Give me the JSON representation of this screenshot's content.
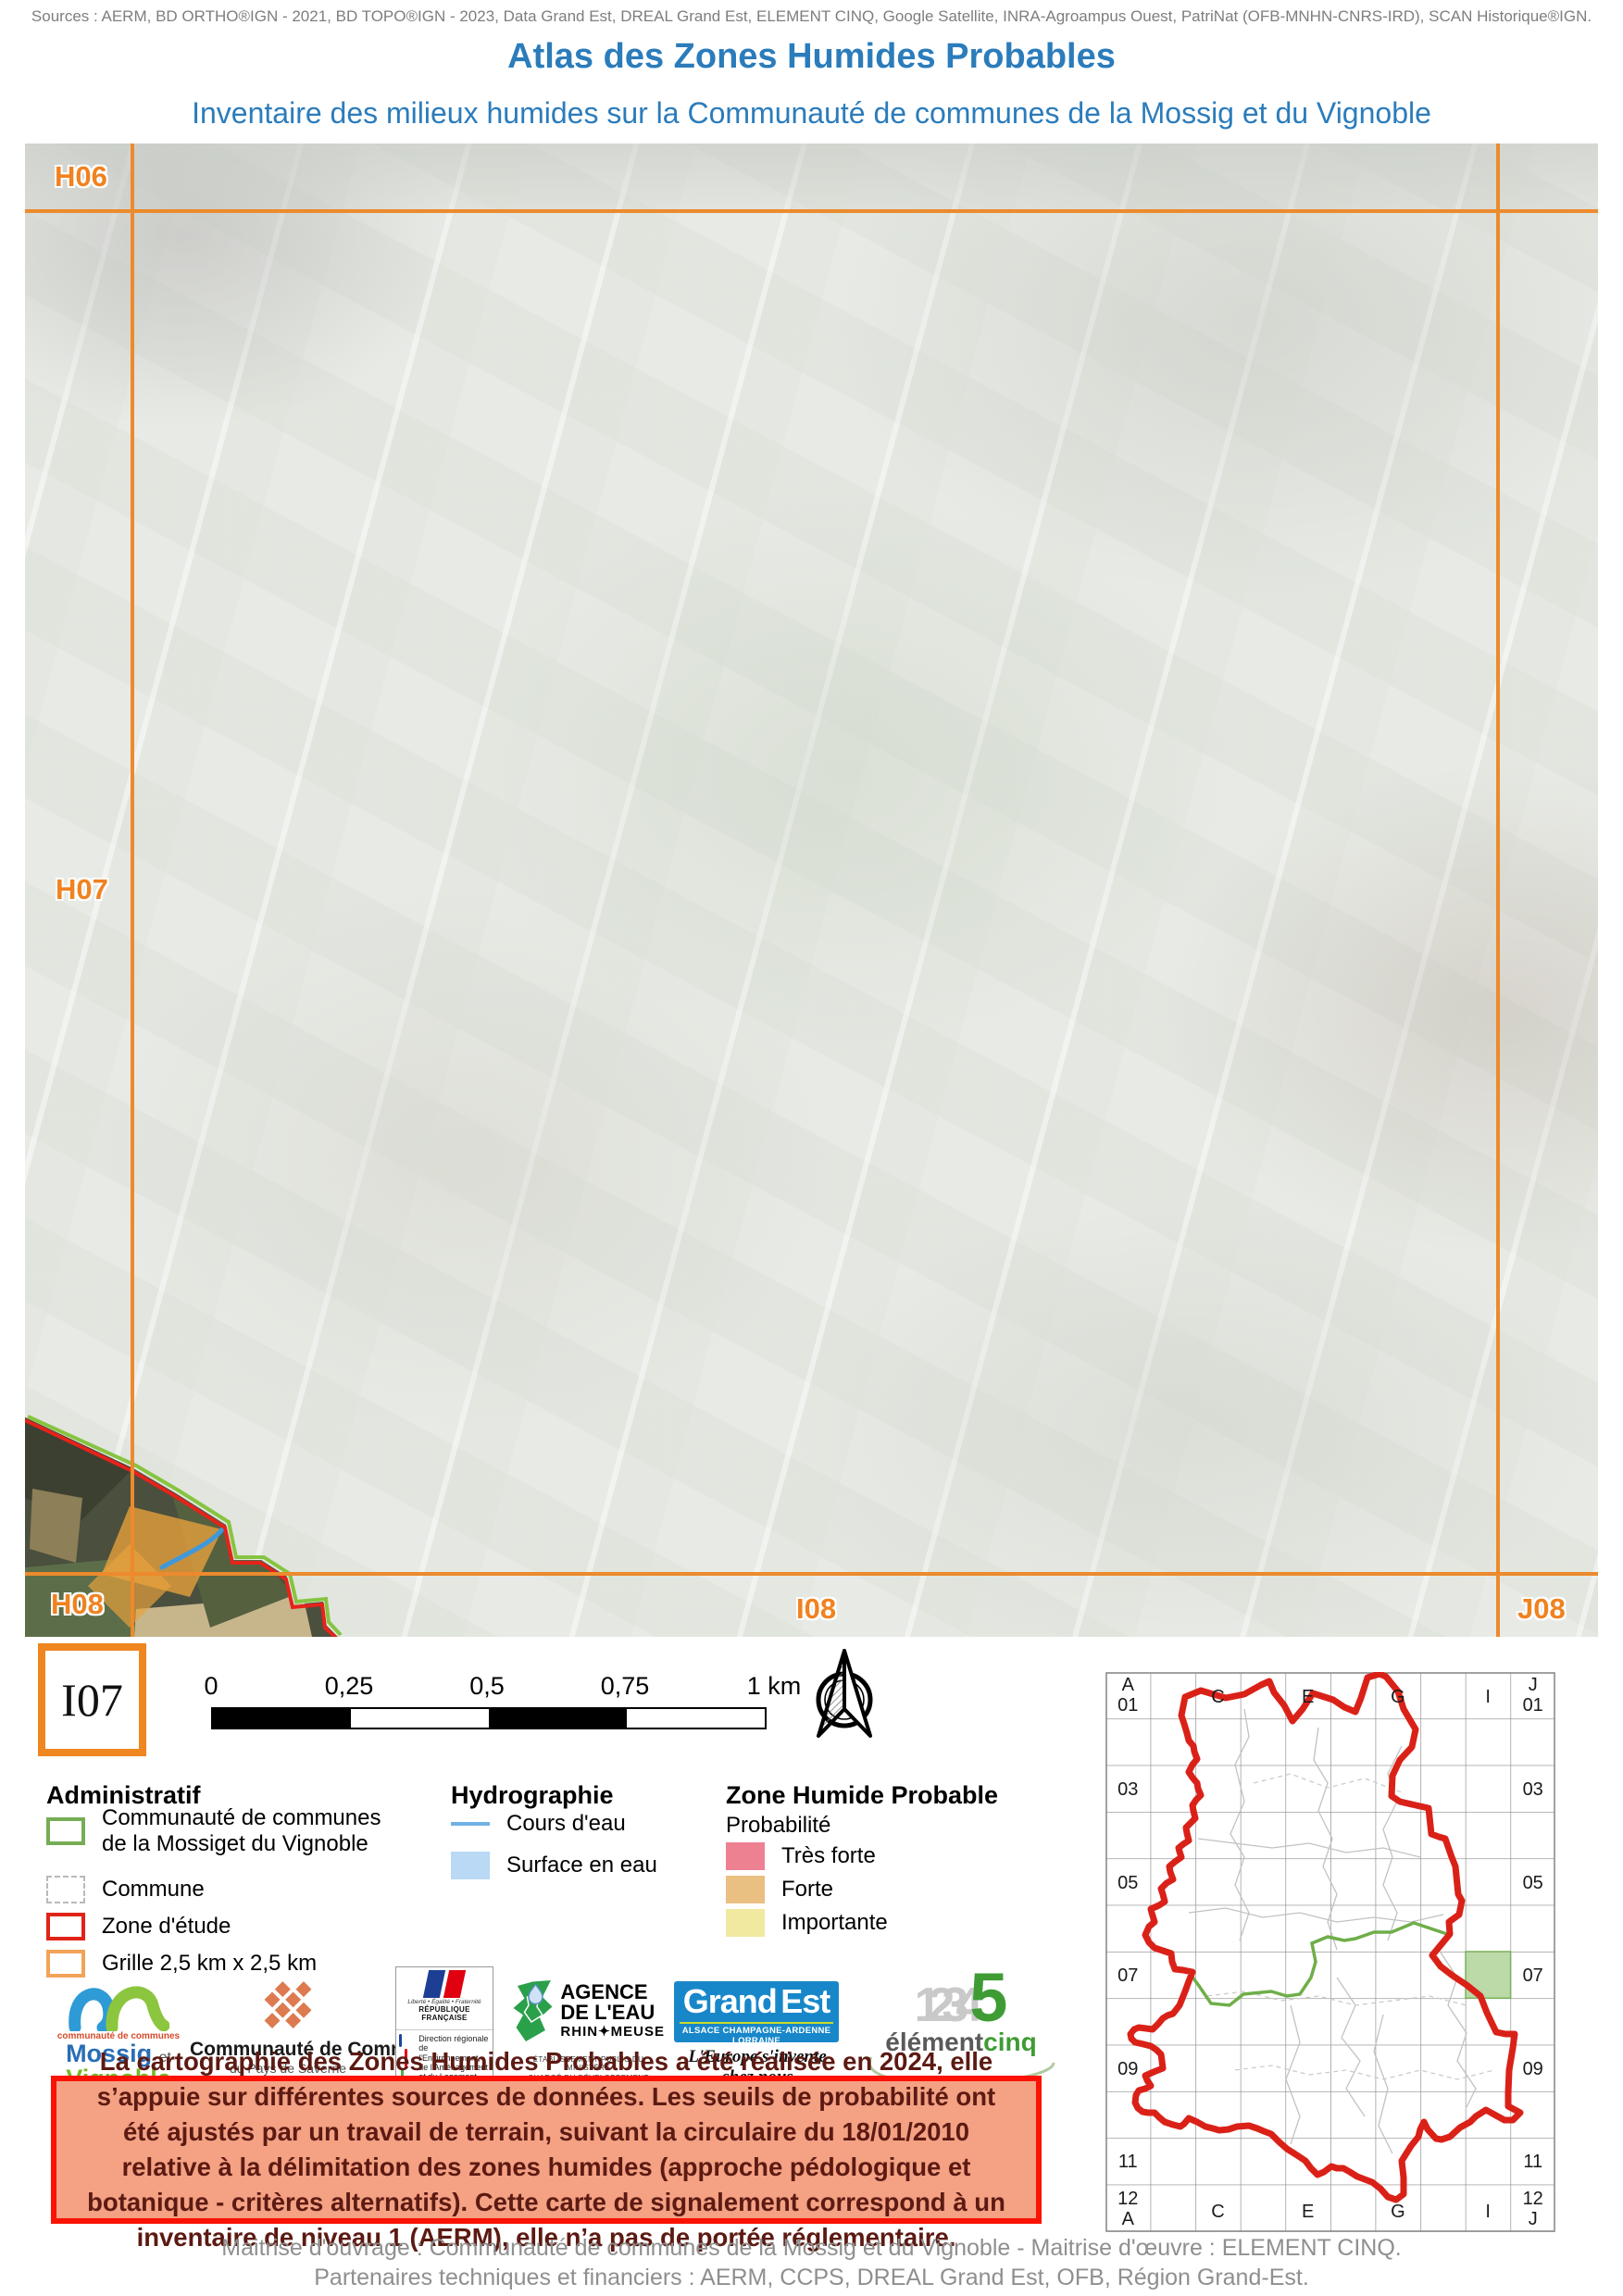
{
  "header": {
    "sources": "Sources : AERM, BD ORTHO®IGN - 2021, BD TOPO®IGN - 2023, Data Grand Est, DREAL Grand Est, ELEMENT CINQ, Google Satellite, INRA-Agroampus Ouest, PatriNat (OFB-MNHN-CNRS-IRD), SCAN Historique®IGN.",
    "title": "Atlas des Zones Humides Probables",
    "subtitle": "Inventaire des milieux humides sur la Communauté de communes de la Mossig et du Vignoble"
  },
  "map": {
    "labels": {
      "h06": "H06",
      "h07": "H07",
      "h08": "H08",
      "i08": "I08",
      "j08": "J08"
    },
    "tile_code": "I07"
  },
  "scalebar": {
    "ticks": [
      "0",
      "0,25",
      "0,5",
      "0,75",
      "1 km"
    ]
  },
  "legend": {
    "administratif": {
      "title": "Administratif",
      "item1_line1": "Communauté de communes",
      "item1_line2": "de la Mossiget du Vignoble",
      "item2": "Commune",
      "item3": "Zone d'étude",
      "item4": "Grille 2,5 km x 2,5 km"
    },
    "hydrographie": {
      "title": "Hydrographie",
      "item1": "Cours d'eau",
      "item2": "Surface en eau"
    },
    "zhp": {
      "title": "Zone Humide Probable",
      "subtitle": "Probabilité",
      "item1": "Très forte",
      "item2": "Forte",
      "item3": "Importante"
    }
  },
  "logos": {
    "mossig": {
      "small": "communauté de communes",
      "name1": "Mossig",
      "et": "et",
      "name2": "Vignoble",
      "region": "Alsace"
    },
    "saverne": {
      "name": "Communauté de Communes",
      "sub": "du Pays de Saverne"
    },
    "rf": {
      "motto": "Liberté • Égalité • Fraternité",
      "republique": "RÉPUBLIQUE FRANÇAISE",
      "dreal1": "Direction régionale",
      "dreal2": "de l'Environnement,",
      "dreal3": "de l'Aménagement",
      "dreal4": "et du Logement",
      "region": "GRAND EST"
    },
    "agence": {
      "name1": "AGENCE",
      "name2": "DE L'EAU",
      "name3": "RHIN✦MEUSE",
      "caption1": "ÉTABLISSEMENT PUBLIC DU MINISTÈRE",
      "caption2": "CHARGÉ DU DÉVELOPPEMENT DURABLE"
    },
    "grandest": {
      "word1": "Grand",
      "word2": "Est",
      "strip": "ALSACE CHAMPAGNE-ARDENNE LORRAINE",
      "tagline": "L'Europe s'invente chez nous"
    },
    "element": {
      "digits": "1234",
      "five": "5",
      "name1": "élément",
      "name2": "cinq"
    }
  },
  "notice": "La cartographie des Zones Humides Probables a été réalisée en 2024, elle s’appuie sur différentes sources de données. Les seuils de probabilité ont été ajustés par un travail de terrain, suivant la circulaire du 18/01/2010 relative à la délimitation des zones humides (approche pédologique et botanique - critères alternatifs). Cette carte de signalement correspond à un inventaire de niveau 1 (AERM), elle n’a pas de portée réglementaire.",
  "overview": {
    "corner_tl": [
      "A",
      "01"
    ],
    "corner_tr": [
      "J",
      "01"
    ],
    "corner_bl": [
      "12",
      "A"
    ],
    "corner_br": [
      "12",
      "J"
    ],
    "top_cols": [
      "C",
      "E",
      "G",
      "I"
    ],
    "bottom_cols": [
      "C",
      "E",
      "G",
      "I"
    ],
    "left_rows": [
      "03",
      "05",
      "07",
      "09",
      "11"
    ],
    "right_rows": [
      "03",
      "05",
      "07",
      "09",
      "11"
    ]
  },
  "footer": {
    "line1": "Maitrise d'ouvrage : Communauté de communes de la Mossig et du Vignoble - Maitrise d'œuvre : ELEMENT CINQ.",
    "line2": "Partenaires techniques et financiers : AERM, CCPS, DREAL Grand Est, OFB, Région Grand-Est."
  },
  "colors": {
    "title_blue": "#2b7cbb",
    "grid_orange": "#ec8a2d",
    "label_orange": "#f08220",
    "legend_green": "#76ad54",
    "legend_red": "#e02318",
    "legend_orange": "#f2a358",
    "stream_blue": "#6fb1e4",
    "water_fill": "#b9d9f4",
    "zhp_tres_forte": "#ed8192",
    "zhp_forte": "#eabf82",
    "zhp_importante": "#f2e9a1",
    "notice_bg": "#f4a184",
    "notice_border": "#fb1205",
    "overview_red": "#da2118",
    "overview_green": "#6fae49",
    "overview_cell": "#bcd9a8"
  }
}
